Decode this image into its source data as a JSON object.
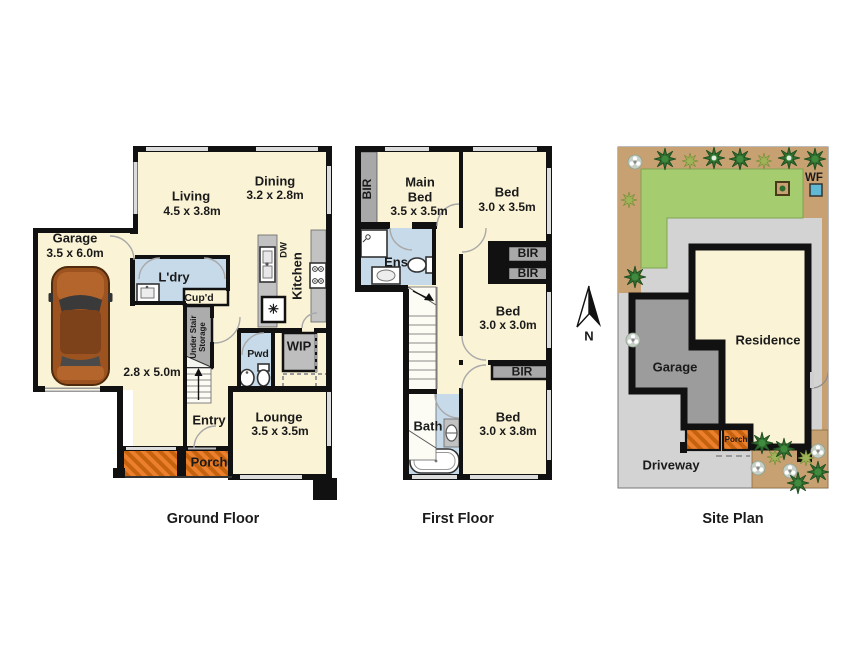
{
  "document": {
    "type": "real-estate floor plan",
    "background": "#ffffff"
  },
  "colors": {
    "wall": "#111111",
    "room_fill": "#FAF3D6",
    "wet_area": "#C7DAEA",
    "porch_orange": "#EC7F2B",
    "porch_hatch": "#C4620F",
    "robe_gray": "#A8A8A8",
    "window_gray": "#DCDCDC",
    "lawn_green": "#A6CC70",
    "garden_tan": "#C8A172",
    "concrete_gray": "#D3D3D3",
    "site_garage_gray": "#9C9C9C",
    "tree_dark_green": "#2E6B2E",
    "bush_light_green": "#9FB459",
    "water_feature_blue": "#5FB8D4"
  },
  "icons": [
    "car-icon",
    "toilet-icon",
    "basin-icon",
    "bathtub-icon",
    "shower-icon",
    "sink-icon",
    "cooktop-icon",
    "dishwasher-label",
    "stairs",
    "tree-icon",
    "bush-icon",
    "flower-icon",
    "north-arrow",
    "water-feature-icon"
  ],
  "ground_floor": {
    "title": "Ground Floor",
    "garage": {
      "name": "Garage",
      "dims": "3.5 x 6.0m"
    },
    "living": {
      "name": "Living",
      "dims": "4.5 x 3.8m"
    },
    "dining": {
      "name": "Dining",
      "dims": "3.2 x 2.8m"
    },
    "ldry": {
      "name": "L'dry"
    },
    "cupd": {
      "name": "Cup'd"
    },
    "under_stair": {
      "line1": "Under Stair",
      "line2": "Storage"
    },
    "dw": {
      "name": "DW"
    },
    "kitchen": {
      "name": "Kitchen"
    },
    "appliance_symbol": "✳",
    "family": {
      "dims": "2.8 x 5.0m"
    },
    "pwd": {
      "name": "Pwd"
    },
    "wip": {
      "name": "WIP"
    },
    "entry": {
      "name": "Entry"
    },
    "lounge": {
      "name": "Lounge",
      "dims": "3.5 x 3.5m"
    },
    "porch": {
      "name": "Porch"
    }
  },
  "first_floor": {
    "title": "First Floor",
    "bir_left": {
      "name": "BIR"
    },
    "main_bed": {
      "line1": "Main",
      "line2": "Bed",
      "dims": "3.5 x 3.5m"
    },
    "bed1": {
      "name": "Bed",
      "dims": "3.0 x 3.5m"
    },
    "bir1": {
      "name": "BIR"
    },
    "bir2": {
      "name": "BIR"
    },
    "ens": {
      "name": "Ens"
    },
    "bed2": {
      "name": "Bed",
      "dims": "3.0 x 3.0m"
    },
    "bir3": {
      "name": "BIR"
    },
    "bath": {
      "name": "Bath"
    },
    "bed3": {
      "name": "Bed",
      "dims": "3.0 x 3.8m"
    }
  },
  "site_plan": {
    "title": "Site Plan",
    "residence": "Residence",
    "garage": "Garage",
    "driveway": "Driveway",
    "porch": "Porch",
    "water_feature": "WF"
  },
  "compass": {
    "label": "N"
  }
}
